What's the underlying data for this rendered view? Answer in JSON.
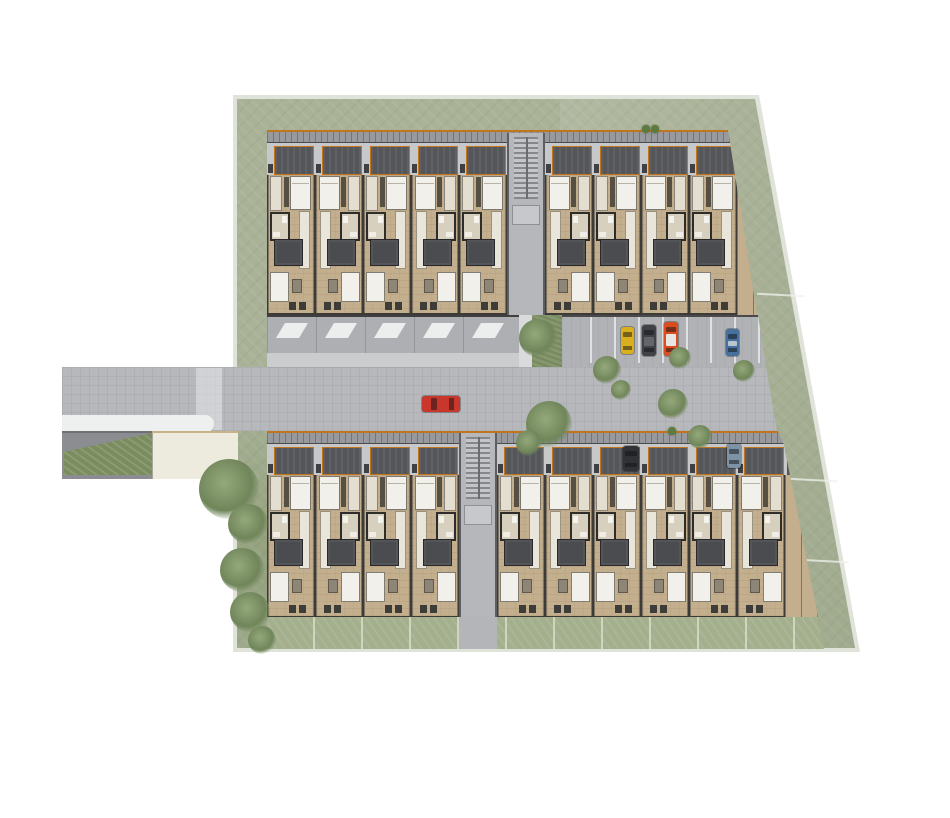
{
  "scene": {
    "type": "architectural-site-plan",
    "view": "top-down-render",
    "description": "Site plan of a rowhouse development: two residential bars with carports flanking a central access road, perimeter lawn with trees, surface parking with four cars, rear garden strips, and a street entrance with planter at the lower left.",
    "canvas": {
      "width": 950,
      "height": 818
    }
  },
  "palette": {
    "page-bg": "#ffffff",
    "site-border": "#e0e3da",
    "lawn": "#a9b197",
    "garden-strip": "#a4b08d",
    "road": "#b7b8bc",
    "parking": "#b1b2b6",
    "roof": "#97999d",
    "carport": "#54565a",
    "divider": "#c7c8ca",
    "tan": "#c3ae8e",
    "wall": "#3c3b38",
    "white-furniture": "#f2f0ea",
    "courtyard": "#4a4c50",
    "stair": "#b5b7bb",
    "orange": "#c2751f",
    "cream": "#edeade",
    "planter": "#7b8d5e",
    "hedge": "#87976d"
  },
  "buildings": {
    "north": {
      "name": "north-rowhouse-bar",
      "units_left": 5,
      "units_right": 4,
      "stairwell": true
    },
    "south": {
      "name": "south-rowhouse-bar",
      "units_left": 4,
      "units_right": 6,
      "stairwell": true
    }
  },
  "garage_doors": 5,
  "parking": {
    "stall_lines": 8
  },
  "cars": [
    {
      "name": "street-car-red",
      "color": "#c8362c",
      "x": 422,
      "y": 396,
      "w": 38,
      "h": 16,
      "orient": "h"
    },
    {
      "name": "parking-car-yellow",
      "color": "#d9af1e",
      "x": 621,
      "y": 327,
      "w": 13,
      "h": 27,
      "orient": "v"
    },
    {
      "name": "parking-car-gray",
      "color": "#404247",
      "x": 642,
      "y": 325,
      "w": 14,
      "h": 31,
      "orient": "v",
      "roof": "#63656a"
    },
    {
      "name": "parking-car-orange",
      "color": "#d94d1f",
      "x": 664,
      "y": 322,
      "w": 14,
      "h": 34,
      "orient": "v",
      "roof": "#e8e6e2"
    },
    {
      "name": "parking-car-blue",
      "color": "#47719c",
      "x": 726,
      "y": 329,
      "w": 13,
      "h": 27,
      "orient": "v",
      "roof": "#b9c4ce"
    },
    {
      "name": "carport-car-dark",
      "color": "#303235",
      "x": 623,
      "y": 446,
      "w": 16,
      "h": 25,
      "orient": "v"
    },
    {
      "name": "carport-car-blue",
      "color": "#7e92a5",
      "x": 727,
      "y": 444,
      "w": 14,
      "h": 24,
      "orient": "v"
    }
  ],
  "trees": [
    {
      "x": 229,
      "y": 489,
      "r": 30
    },
    {
      "x": 248,
      "y": 524,
      "r": 20
    },
    {
      "x": 242,
      "y": 570,
      "r": 22
    },
    {
      "x": 250,
      "y": 612,
      "r": 20
    },
    {
      "x": 262,
      "y": 640,
      "r": 14
    },
    {
      "x": 538,
      "y": 338,
      "r": 19
    },
    {
      "x": 549,
      "y": 424,
      "r": 23
    },
    {
      "x": 529,
      "y": 443,
      "r": 13
    },
    {
      "x": 607,
      "y": 370,
      "r": 14
    },
    {
      "x": 621,
      "y": 390,
      "r": 10
    },
    {
      "x": 673,
      "y": 404,
      "r": 15
    },
    {
      "x": 680,
      "y": 358,
      "r": 11
    },
    {
      "x": 744,
      "y": 371,
      "r": 11
    },
    {
      "x": 700,
      "y": 437,
      "r": 12
    }
  ],
  "roof_plants": [
    {
      "x": 646,
      "y": 129,
      "r": 4
    },
    {
      "x": 655,
      "y": 129,
      "r": 4
    },
    {
      "x": 672,
      "y": 431,
      "r": 4
    }
  ]
}
